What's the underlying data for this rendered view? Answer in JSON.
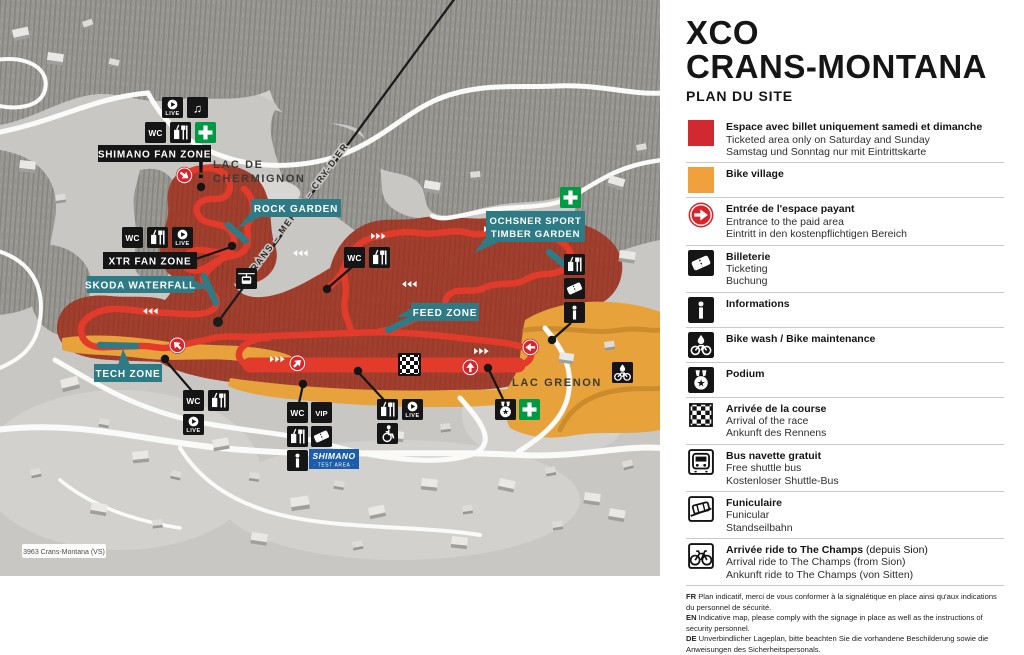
{
  "map": {
    "attribution": "3963 Crans-Montana (VS)",
    "gondola_line_label": "CRANS – MERBÉ – CRY-D'ER",
    "places": {
      "lac_de_chermignon_line1": "LAC DE",
      "lac_de_chermignon_line2": "CHERMIGNON",
      "lac_grenon": "LAC GRENON"
    },
    "zones": {
      "shimano_fan_zone": "SHIMANO FAN ZONE",
      "xtr_fan_zone": "XTR FAN ZONE",
      "rock_garden": "ROCK GARDEN",
      "skoda_waterfall": "SKODA WATERFALL",
      "tech_zone": "TECH ZONE",
      "feed_zone": "FEED ZONE",
      "ochsner_line1": "OCHSNER SPORT",
      "ochsner_line2": "TIMBER GARDEN"
    },
    "icon_labels": {
      "wc": "WC",
      "vip": "VIP",
      "live": "LIVE",
      "music": "♫",
      "warning": "!",
      "shimano": "SHIMANO",
      "test_area": "· TEST AREA ·"
    }
  },
  "panel": {
    "title_1": "XCO",
    "title_2": "CRANS-MONTANA",
    "subtitle": "PLAN DU SITE",
    "legend": [
      {
        "t": "Espace avec billet uniquement samedi et dimanche",
        "ts": "",
        "l2": "Ticketed area only on Saturday and Sunday",
        "l3": "Samstag und Sonntag nur mit Eintrittskarte"
      },
      {
        "t": "Bike village",
        "ts": "",
        "l2": "",
        "l3": ""
      },
      {
        "t": "Entrée de l'espace payant",
        "ts": "",
        "l2": "Entrance to the paid area",
        "l3": "Eintritt in den kostenpflichtigen Bereich"
      },
      {
        "t": "Billeterie",
        "ts": "",
        "l2": "Ticketing",
        "l3": "Buchung"
      },
      {
        "t": "Informations",
        "ts": "",
        "l2": "",
        "l3": ""
      },
      {
        "t": "Bike wash / Bike maintenance",
        "ts": "",
        "l2": "",
        "l3": ""
      },
      {
        "t": "Podium",
        "ts": "",
        "l2": "",
        "l3": ""
      },
      {
        "t": "Arrivée de la course",
        "ts": "",
        "l2": "Arrival of the race",
        "l3": "Ankunft des Rennens"
      },
      {
        "t": "Bus navette gratuit",
        "ts": "",
        "l2": "Free shuttle bus",
        "l3": "Kostenloser Shuttle-Bus"
      },
      {
        "t": "Funiculaire",
        "ts": "",
        "l2": "Funicular",
        "l3": "Standseilbahn"
      },
      {
        "t": "Arrivée ride to The Champs",
        "ts": " (depuis Sion)",
        "l2": "Arrival ride to The Champs (from Sion)",
        "l3": "Ankunft ride to The Champs (von Sitten)"
      }
    ],
    "footer": [
      {
        "k": "FR",
        "t": " Plan indicatif, merci de vous conformer à la signalétique en place ainsi qu'aux indications du personnel de sécurité."
      },
      {
        "k": "EN",
        "t": " Indicative map, please comply with the signage in place as well as the instructions of security personnel."
      },
      {
        "k": "DE",
        "t": " Unverbindlicher Lageplan, bitte beachten Sie die vorhandene Beschilderung sowie die Anweisungen des Sicherheitspersonals."
      }
    ]
  },
  "colors": {
    "course_red": "#e23a2b",
    "ticketed_area_red": "#a33f2f",
    "legend_red": "#d02932",
    "bike_village_orange": "#e7a23c",
    "feature_teal": "#2e7b86",
    "first_aid_green": "#009a44",
    "shimano_blue": "#1b5cab",
    "entrance_red": "#d6252b",
    "map_background": "#c8c7c4"
  }
}
